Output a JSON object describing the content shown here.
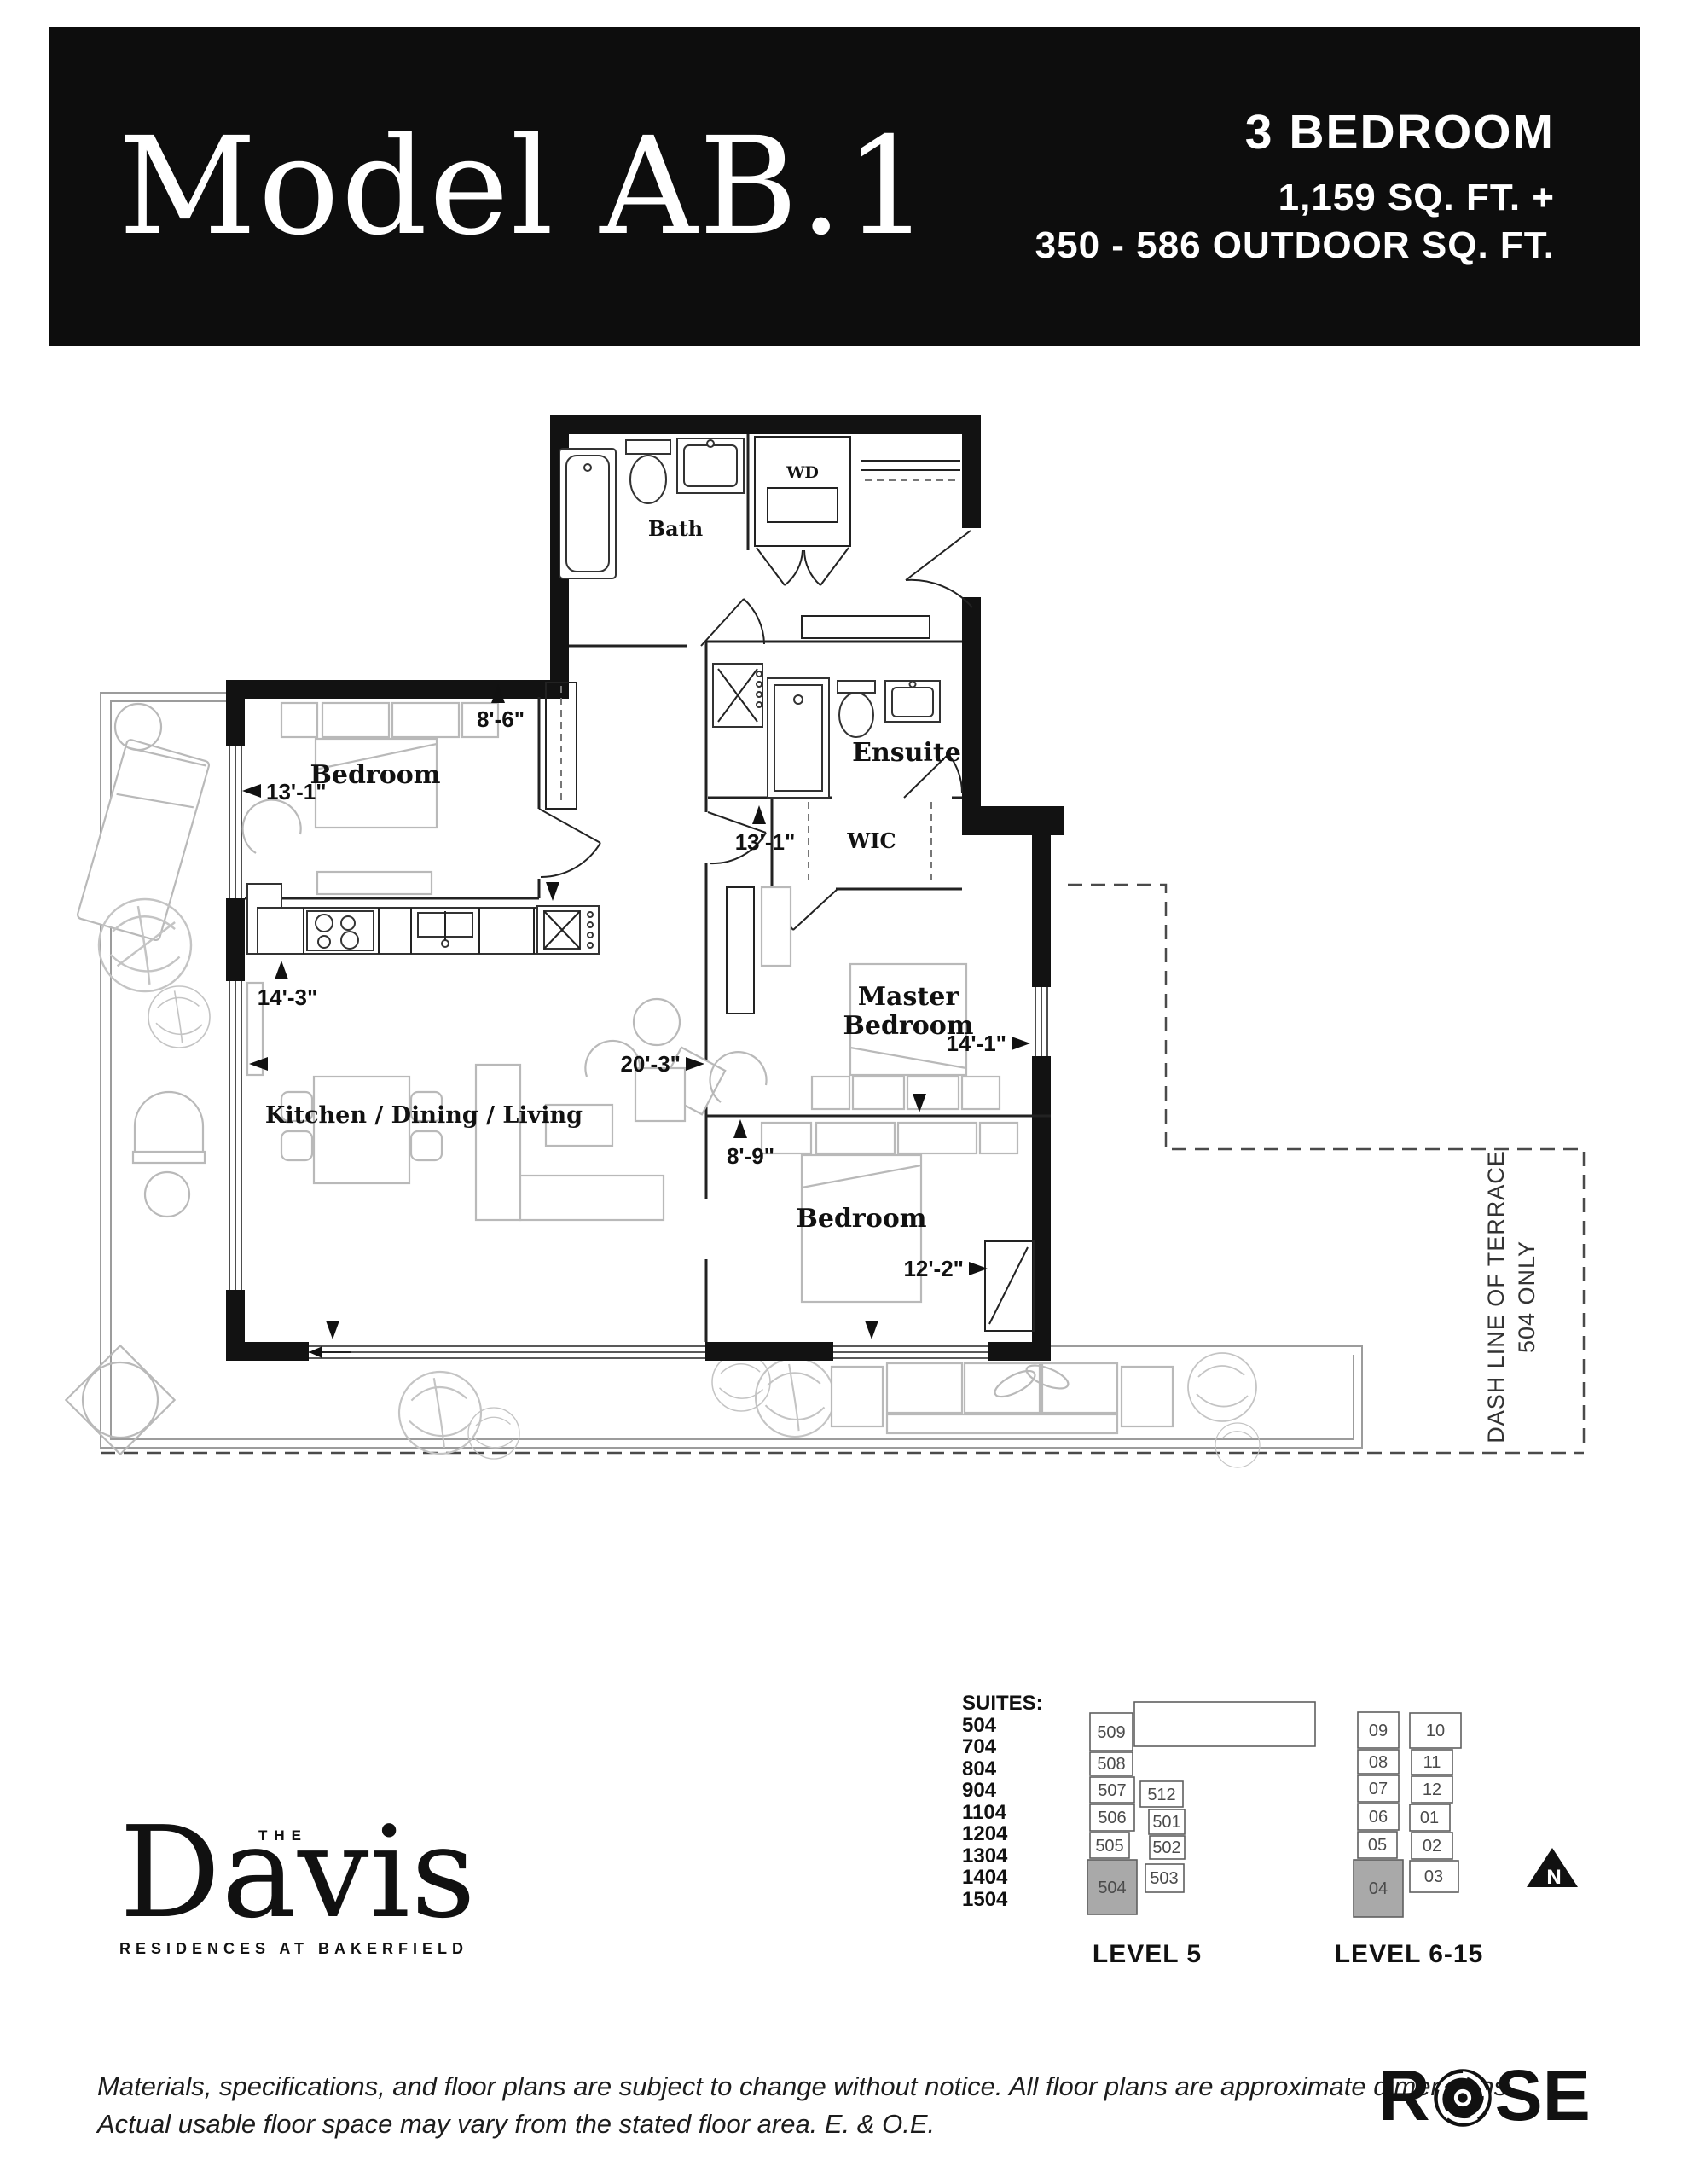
{
  "header": {
    "model": "Model AB.1",
    "type": "3 BEDROOM",
    "area_line1": "1,159 SQ. FT. +",
    "area_line2": "350 - 586 OUTDOOR SQ. FT."
  },
  "plan": {
    "rooms": {
      "bath": "Bath",
      "wd": "WD",
      "bedroom1": "Bedroom",
      "ensuite": "Ensuite",
      "wic": "WIC",
      "master_line1": "Master",
      "master_line2": "Bedroom",
      "kitchen": "Kitchen / Dining / Living",
      "bedroom2": "Bedroom"
    },
    "dims": {
      "d86": "8'-6\"",
      "d131a": "13'-1\"",
      "d143": "14'-3\"",
      "d131b": "13'-1\"",
      "d203": "20'-3\"",
      "d89": "8'-9\"",
      "d141": "14'-1\"",
      "d122": "12'-2\""
    },
    "terrace_note_line1": "DASH LINE OF TERRACE",
    "terrace_note_line2": "504 ONLY"
  },
  "suites": {
    "title": "SUITES:",
    "items": [
      "504",
      "704",
      "804",
      "904",
      "1104",
      "1204",
      "1304",
      "1404",
      "1504"
    ]
  },
  "keyplan5": {
    "label": "LEVEL 5",
    "cells": [
      "509",
      "508",
      "507",
      "506",
      "505",
      "512",
      "501",
      "502",
      "503"
    ],
    "highlight": "504"
  },
  "keyplan615": {
    "label": "LEVEL 6-15",
    "cells": [
      "09",
      "08",
      "07",
      "06",
      "05",
      "10",
      "11",
      "12",
      "01",
      "02",
      "03"
    ],
    "highlight": "04"
  },
  "north": "N",
  "brand": {
    "the": "THE",
    "name": "Davis",
    "tagline": "RESIDENCES AT BAKERFIELD"
  },
  "footer": {
    "line1": "Materials, specifications, and floor plans are subject to change without notice. All floor plans are approximate dimensions.",
    "line2": "Actual usable floor space may vary from the stated floor area. E. & O.E.",
    "logo_r": "R",
    "logo_se": "SE"
  },
  "colors": {
    "banner": "#0d0d0d",
    "suite_highlight": "#a9a9a9"
  }
}
